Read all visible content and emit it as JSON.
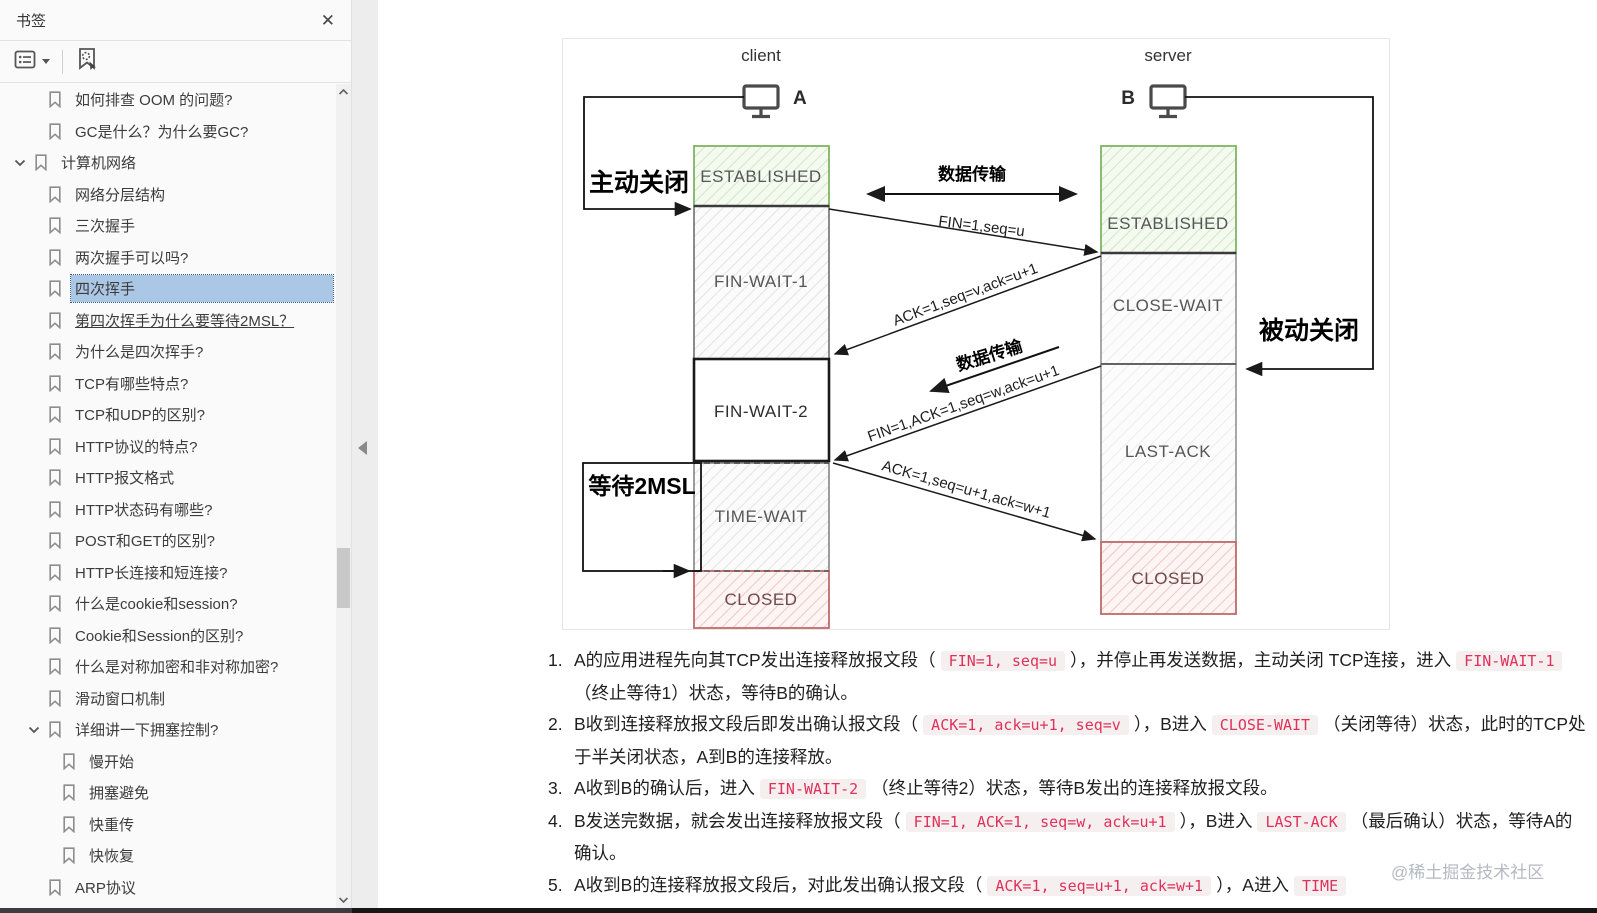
{
  "sidebar": {
    "title": "书签",
    "icons": {
      "close": "close-icon",
      "options": "bookmark-options-icon",
      "caret": "caret-down-icon",
      "locate": "locate-bookmark-icon",
      "chevron_expanded": "chevron-down-icon",
      "bookmark": "bookmark-icon",
      "scroll_up": "scroll-up-icon",
      "scroll_down": "scroll-down-icon",
      "collapse_panel": "collapse-panel-icon"
    },
    "items": [
      {
        "label": "如何排查 OOM 的问题?",
        "level": 2
      },
      {
        "label": "GC是什么？为什么要GC?",
        "level": 2
      },
      {
        "label": "计算机网络",
        "level": 1,
        "expandable": true
      },
      {
        "label": "网络分层结构",
        "level": 2
      },
      {
        "label": "三次握手",
        "level": 2
      },
      {
        "label": "两次握手可以吗?",
        "level": 2
      },
      {
        "label": "四次挥手",
        "level": 2,
        "selected": true
      },
      {
        "label": "第四次挥手为什么要等待2MSL？",
        "level": 2,
        "underline": true
      },
      {
        "label": "为什么是四次挥手?",
        "level": 2
      },
      {
        "label": "TCP有哪些特点?",
        "level": 2
      },
      {
        "label": "TCP和UDP的区别?",
        "level": 2
      },
      {
        "label": "HTTP协议的特点?",
        "level": 2
      },
      {
        "label": "HTTP报文格式",
        "level": 2
      },
      {
        "label": "HTTP状态码有哪些?",
        "level": 2
      },
      {
        "label": "POST和GET的区别?",
        "level": 2
      },
      {
        "label": "HTTP长连接和短连接?",
        "level": 2
      },
      {
        "label": "什么是cookie和session?",
        "level": 2
      },
      {
        "label": "Cookie和Session的区别?",
        "level": 2
      },
      {
        "label": "什么是对称加密和非对称加密?",
        "level": 2
      },
      {
        "label": "滑动窗口机制",
        "level": 2
      },
      {
        "label": "详细讲一下拥塞控制?",
        "level": 2,
        "expandable": true
      },
      {
        "label": "慢开始",
        "level": 3
      },
      {
        "label": "拥塞避免",
        "level": 3
      },
      {
        "label": "快重传",
        "level": 3
      },
      {
        "label": "快恢复",
        "level": 3
      },
      {
        "label": "ARP协议",
        "level": 2
      }
    ]
  },
  "diagram": {
    "client": {
      "title": "client",
      "host": "A",
      "states": [
        "ESTABLISHED",
        "FIN-WAIT-1",
        "FIN-WAIT-2",
        "TIME-WAIT",
        "CLOSED"
      ]
    },
    "server": {
      "title": "server",
      "host": "B",
      "states": [
        "ESTABLISHED",
        "CLOSE-WAIT",
        "LAST-ACK",
        "CLOSED"
      ]
    },
    "labels": {
      "active_close": "主动关闭",
      "passive_close": "被动关闭",
      "wait_2msl": "等待2MSL",
      "data_transfer_top": "数据传输",
      "data_transfer_mid": "数据传输"
    },
    "messages": [
      "FIN=1,seq=u",
      "ACK=1,seq=v,ack=u+1",
      "FIN=1,ACK=1,seq=w,ack=u+1",
      "ACK=1,seq=u+1,ack=w+1"
    ],
    "colors": {
      "established_border": "#7fb463",
      "closed_border": "#bf6b6b",
      "gray_border": "#5b5b5b"
    }
  },
  "notes": {
    "items": [
      {
        "num": "1.",
        "segments": [
          {
            "t": "text",
            "v": "A的应用进程先向其TCP发出连接释放报文段（"
          },
          {
            "t": "code",
            "v": "FIN=1, seq=u"
          },
          {
            "t": "text",
            "v": "），并停止再发送数据，主动关闭 TCP连接，进入"
          },
          {
            "t": "code",
            "v": "FIN-WAIT-1"
          },
          {
            "t": "text",
            "v": "（终止等待1）状态，等待B的确认。"
          }
        ]
      },
      {
        "num": "2.",
        "segments": [
          {
            "t": "text",
            "v": "B收到连接释放报文段后即发出确认报文段（"
          },
          {
            "t": "code",
            "v": "ACK=1, ack=u+1, seq=v"
          },
          {
            "t": "text",
            "v": "），B进入"
          },
          {
            "t": "code",
            "v": "CLOSE-WAIT"
          },
          {
            "t": "text",
            "v": "（关闭等待）状态，此时的TCP处于半关闭状态，A到B的连接释放。"
          }
        ]
      },
      {
        "num": "3.",
        "segments": [
          {
            "t": "text",
            "v": "A收到B的确认后，进入"
          },
          {
            "t": "code",
            "v": "FIN-WAIT-2"
          },
          {
            "t": "text",
            "v": "（终止等待2）状态，等待B发出的连接释放报文段。"
          }
        ]
      },
      {
        "num": "4.",
        "segments": [
          {
            "t": "text",
            "v": "B发送完数据，就会发出连接释放报文段（"
          },
          {
            "t": "code",
            "v": "FIN=1, ACK=1, seq=w, ack=u+1"
          },
          {
            "t": "text",
            "v": "），B进入"
          },
          {
            "t": "code",
            "v": "LAST-ACK"
          },
          {
            "t": "text",
            "v": "（最后确认）状态，等待A的确认。"
          }
        ]
      },
      {
        "num": "5.",
        "segments": [
          {
            "t": "text",
            "v": "A收到B的连接释放报文段后，对此发出确认报文段（"
          },
          {
            "t": "code",
            "v": "ACK=1, seq=u+1, ack=w+1"
          },
          {
            "t": "text",
            "v": "），A进入"
          },
          {
            "t": "code",
            "v": "TIME"
          }
        ]
      }
    ]
  },
  "watermark": "@稀土掘金技术社区"
}
